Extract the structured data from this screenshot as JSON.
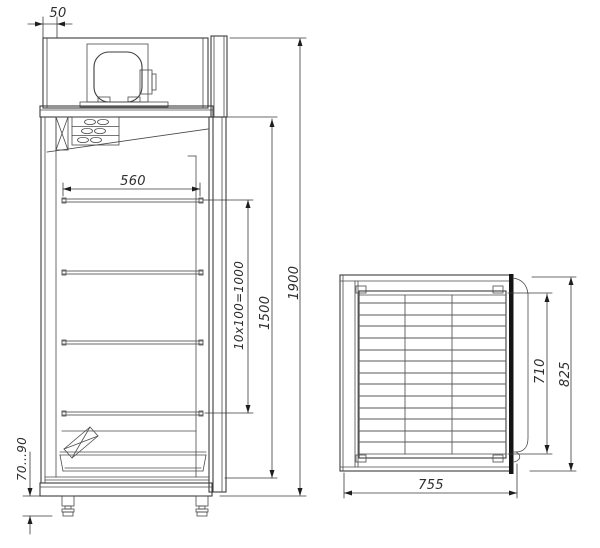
{
  "colors": {
    "background": "#ffffff",
    "line": "#3d3d3d",
    "dimension": "#3a3a3a",
    "text": "#2e2e2e",
    "door_fill": "#141414"
  },
  "front_view": {
    "dimensions": {
      "top_offset": "50",
      "shelf_width": "560",
      "shelf_pitch": "10x100=1000",
      "interior_height": "1500",
      "overall_height": "1900",
      "leg_height": "70...90"
    }
  },
  "top_view": {
    "dimensions": {
      "inner_depth": "710",
      "outer_depth": "825",
      "overall_width": "755"
    }
  }
}
